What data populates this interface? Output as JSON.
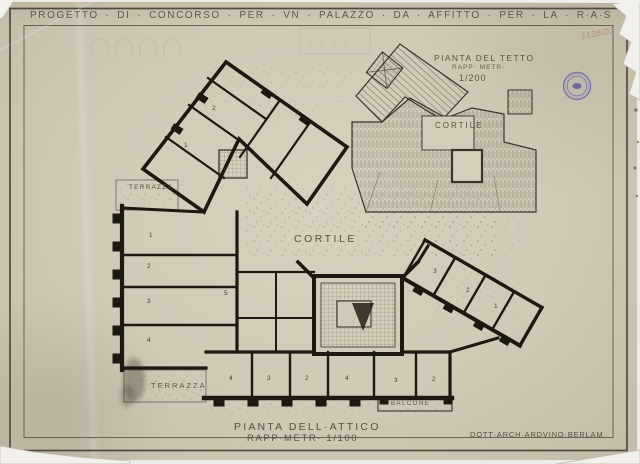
{
  "header": {
    "title": "PROGETTO · DI · CONCORSO · PER · VN · PALAZZO · DA · AFFITTO · PER · LA · R·A·S"
  },
  "annotations": {
    "archive_number": "1138/02",
    "signature": "DOTT·ARCH·ARDVINO·BERLAM"
  },
  "roof_plan": {
    "title": "PIANTA DEL TETTO",
    "scale_label": "RAPP· METR·",
    "scale_value": "1/200",
    "courtyard": "CORTILE"
  },
  "attic_plan": {
    "courtyard": "CORTILE",
    "terrace_upper": "TERRAZZA",
    "terrace_lower": "TERRAZZA",
    "balcony": "BALCONE",
    "caption": {
      "title": "PIANTA DELL·ATTICO",
      "scale": "RAPP·METR· 1/100"
    },
    "rooms": {
      "diagonal_wing": [
        "1",
        "2"
      ],
      "left_wing": [
        "1",
        "2",
        "3",
        "4"
      ],
      "middle": [
        "5"
      ],
      "bottom_wing": [
        "4",
        "3",
        "2",
        "4",
        "3",
        "2"
      ],
      "right_wing": [
        "3",
        "2",
        "1"
      ]
    }
  },
  "colors": {
    "paper": "#cfc9b6",
    "ink": "#4e4635",
    "wall": "#1d1810",
    "stamp_purple": "#6a5fae",
    "pencil_red": "#ad8577"
  }
}
